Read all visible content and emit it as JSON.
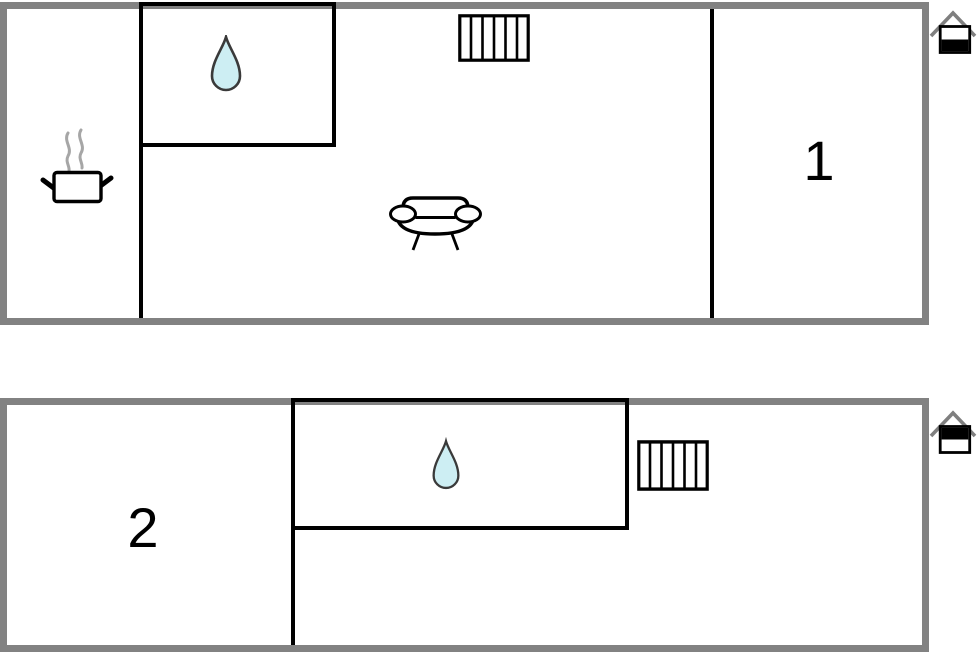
{
  "palette": {
    "background": "#ffffff",
    "outer_wall": "#828282",
    "inner_wall": "#000000",
    "water_fill": "#cdeef3",
    "water_stroke": "#3a3a3a",
    "steam": "#a6a6a6",
    "roof": "#7f7f7f",
    "icon_stroke": "#000000",
    "label_color": "#000000"
  },
  "floors": [
    {
      "name": "ground-floor-plan",
      "room_label": "1",
      "level_indicator": "ground-floor",
      "features": [
        "cooking-pot-icon",
        "water-drop-icon",
        "radiator-icon",
        "sofa-icon",
        "house-ground-floor-icon"
      ]
    },
    {
      "name": "upper-floor-plan",
      "room_label": "2",
      "level_indicator": "upper-floor",
      "features": [
        "water-drop-icon",
        "radiator-icon",
        "house-upper-floor-icon"
      ]
    }
  ]
}
